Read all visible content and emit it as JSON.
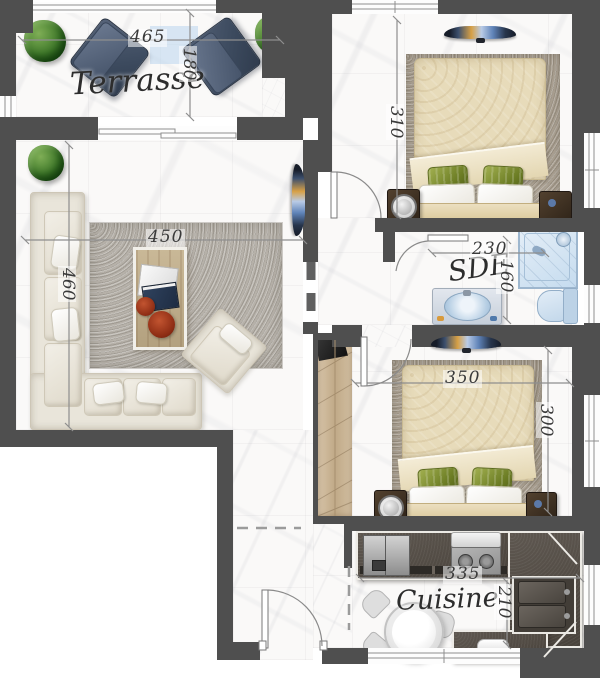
{
  "rooms": {
    "terrasse": {
      "label": "Terrasse",
      "dim_width": "465",
      "dim_depth": "180"
    },
    "living": {
      "dim_width": "450",
      "dim_depth": "460"
    },
    "bedroom_top": {
      "dim_depth": "310"
    },
    "sde": {
      "label": "SDE",
      "dim_width": "230",
      "dim_depth": "160"
    },
    "bedroom_bottom": {
      "dim_width": "350",
      "dim_depth": "300"
    },
    "kitchen": {
      "label": "Cuisine",
      "dim_width": "335",
      "dim_depth": "210"
    }
  },
  "palette": {
    "wall": "#4f4f4f",
    "floor_marble": "#faf9f8",
    "living_rug": "#b6b1a9",
    "bedroom_rug": "#aca294",
    "duvet_beige": "#e7dbba",
    "pillow_green": "#7c8c2e",
    "sofa_cream": "#e9e5da",
    "terrace_chair_navy": "#46546a",
    "plant_green": "#3e7829",
    "bath_fixture_blue": "#c2d7ea",
    "kitchen_counter": "#4f4841",
    "decor_red": "#99331a",
    "dimension_line": "#8a8a8a",
    "label_text": "#2d2d2d"
  },
  "furniture": {
    "terrasse": [
      "potted-plant",
      "lounge-chair",
      "lounge-chair",
      "potted-plant"
    ],
    "living": [
      "potted-plant",
      "corner-sofa",
      "throw-pillows",
      "coffee-table",
      "magazines",
      "decor-bowls",
      "armchair",
      "area-rug",
      "wall-tv"
    ],
    "bedroom_top": [
      "area-rug",
      "double-bed",
      "duvet",
      "pillows",
      "nightstand",
      "table-lamp",
      "nightstand",
      "wall-tv"
    ],
    "sde": [
      "shower",
      "washbasin-vanity",
      "toilet"
    ],
    "bedroom_bottom": [
      "area-rug",
      "double-bed",
      "duvet",
      "pillows",
      "nightstand",
      "table-lamp",
      "nightstand",
      "wall-tv",
      "wardrobe",
      "shoe-cabinet"
    ],
    "kitchen": [
      "fridge",
      "cooktop",
      "extractor-hood",
      "counter",
      "double-sink",
      "dining-table",
      "dining-chairs",
      "serving-dish"
    ]
  }
}
